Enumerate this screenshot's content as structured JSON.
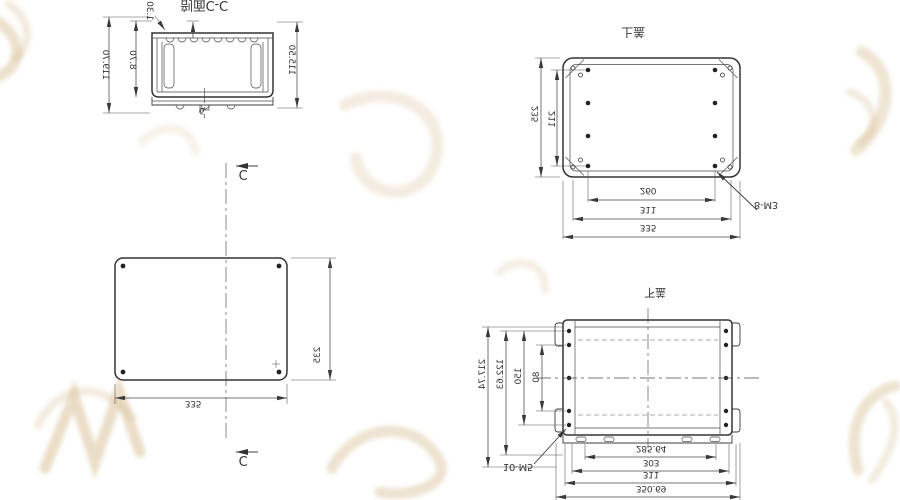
{
  "colors": {
    "line": "#3a3a3a",
    "watermark": "#d6bd92",
    "background": "#ffffff"
  },
  "section_view": {
    "title": "剖面C-C",
    "dim_total_height": "119.70",
    "dim_lid": "8.70",
    "dim_wall": "1.30",
    "dim_inner_height": "115.50",
    "dim_hole": "6"
  },
  "plan_view": {
    "section_mark": "C",
    "dim_width": "335",
    "dim_height": "235"
  },
  "top_cover_view": {
    "title": "上盖",
    "screw_note": "8-M3",
    "dim_height": "235",
    "dim_hole_rows": "211",
    "dim_hole_cols": "260",
    "dim_screw_span": "311",
    "dim_width": "335"
  },
  "bottom_cover_view": {
    "title": "下盖",
    "screw_note": "10-M5",
    "dim_left_1": "217.74",
    "dim_left_2": "122.63",
    "dim_left_3": "150",
    "dim_left_4": "80",
    "dim_bottom_1": "285.64",
    "dim_bottom_2": "303",
    "dim_bottom_3": "311",
    "dim_bottom_4": "350.69"
  }
}
